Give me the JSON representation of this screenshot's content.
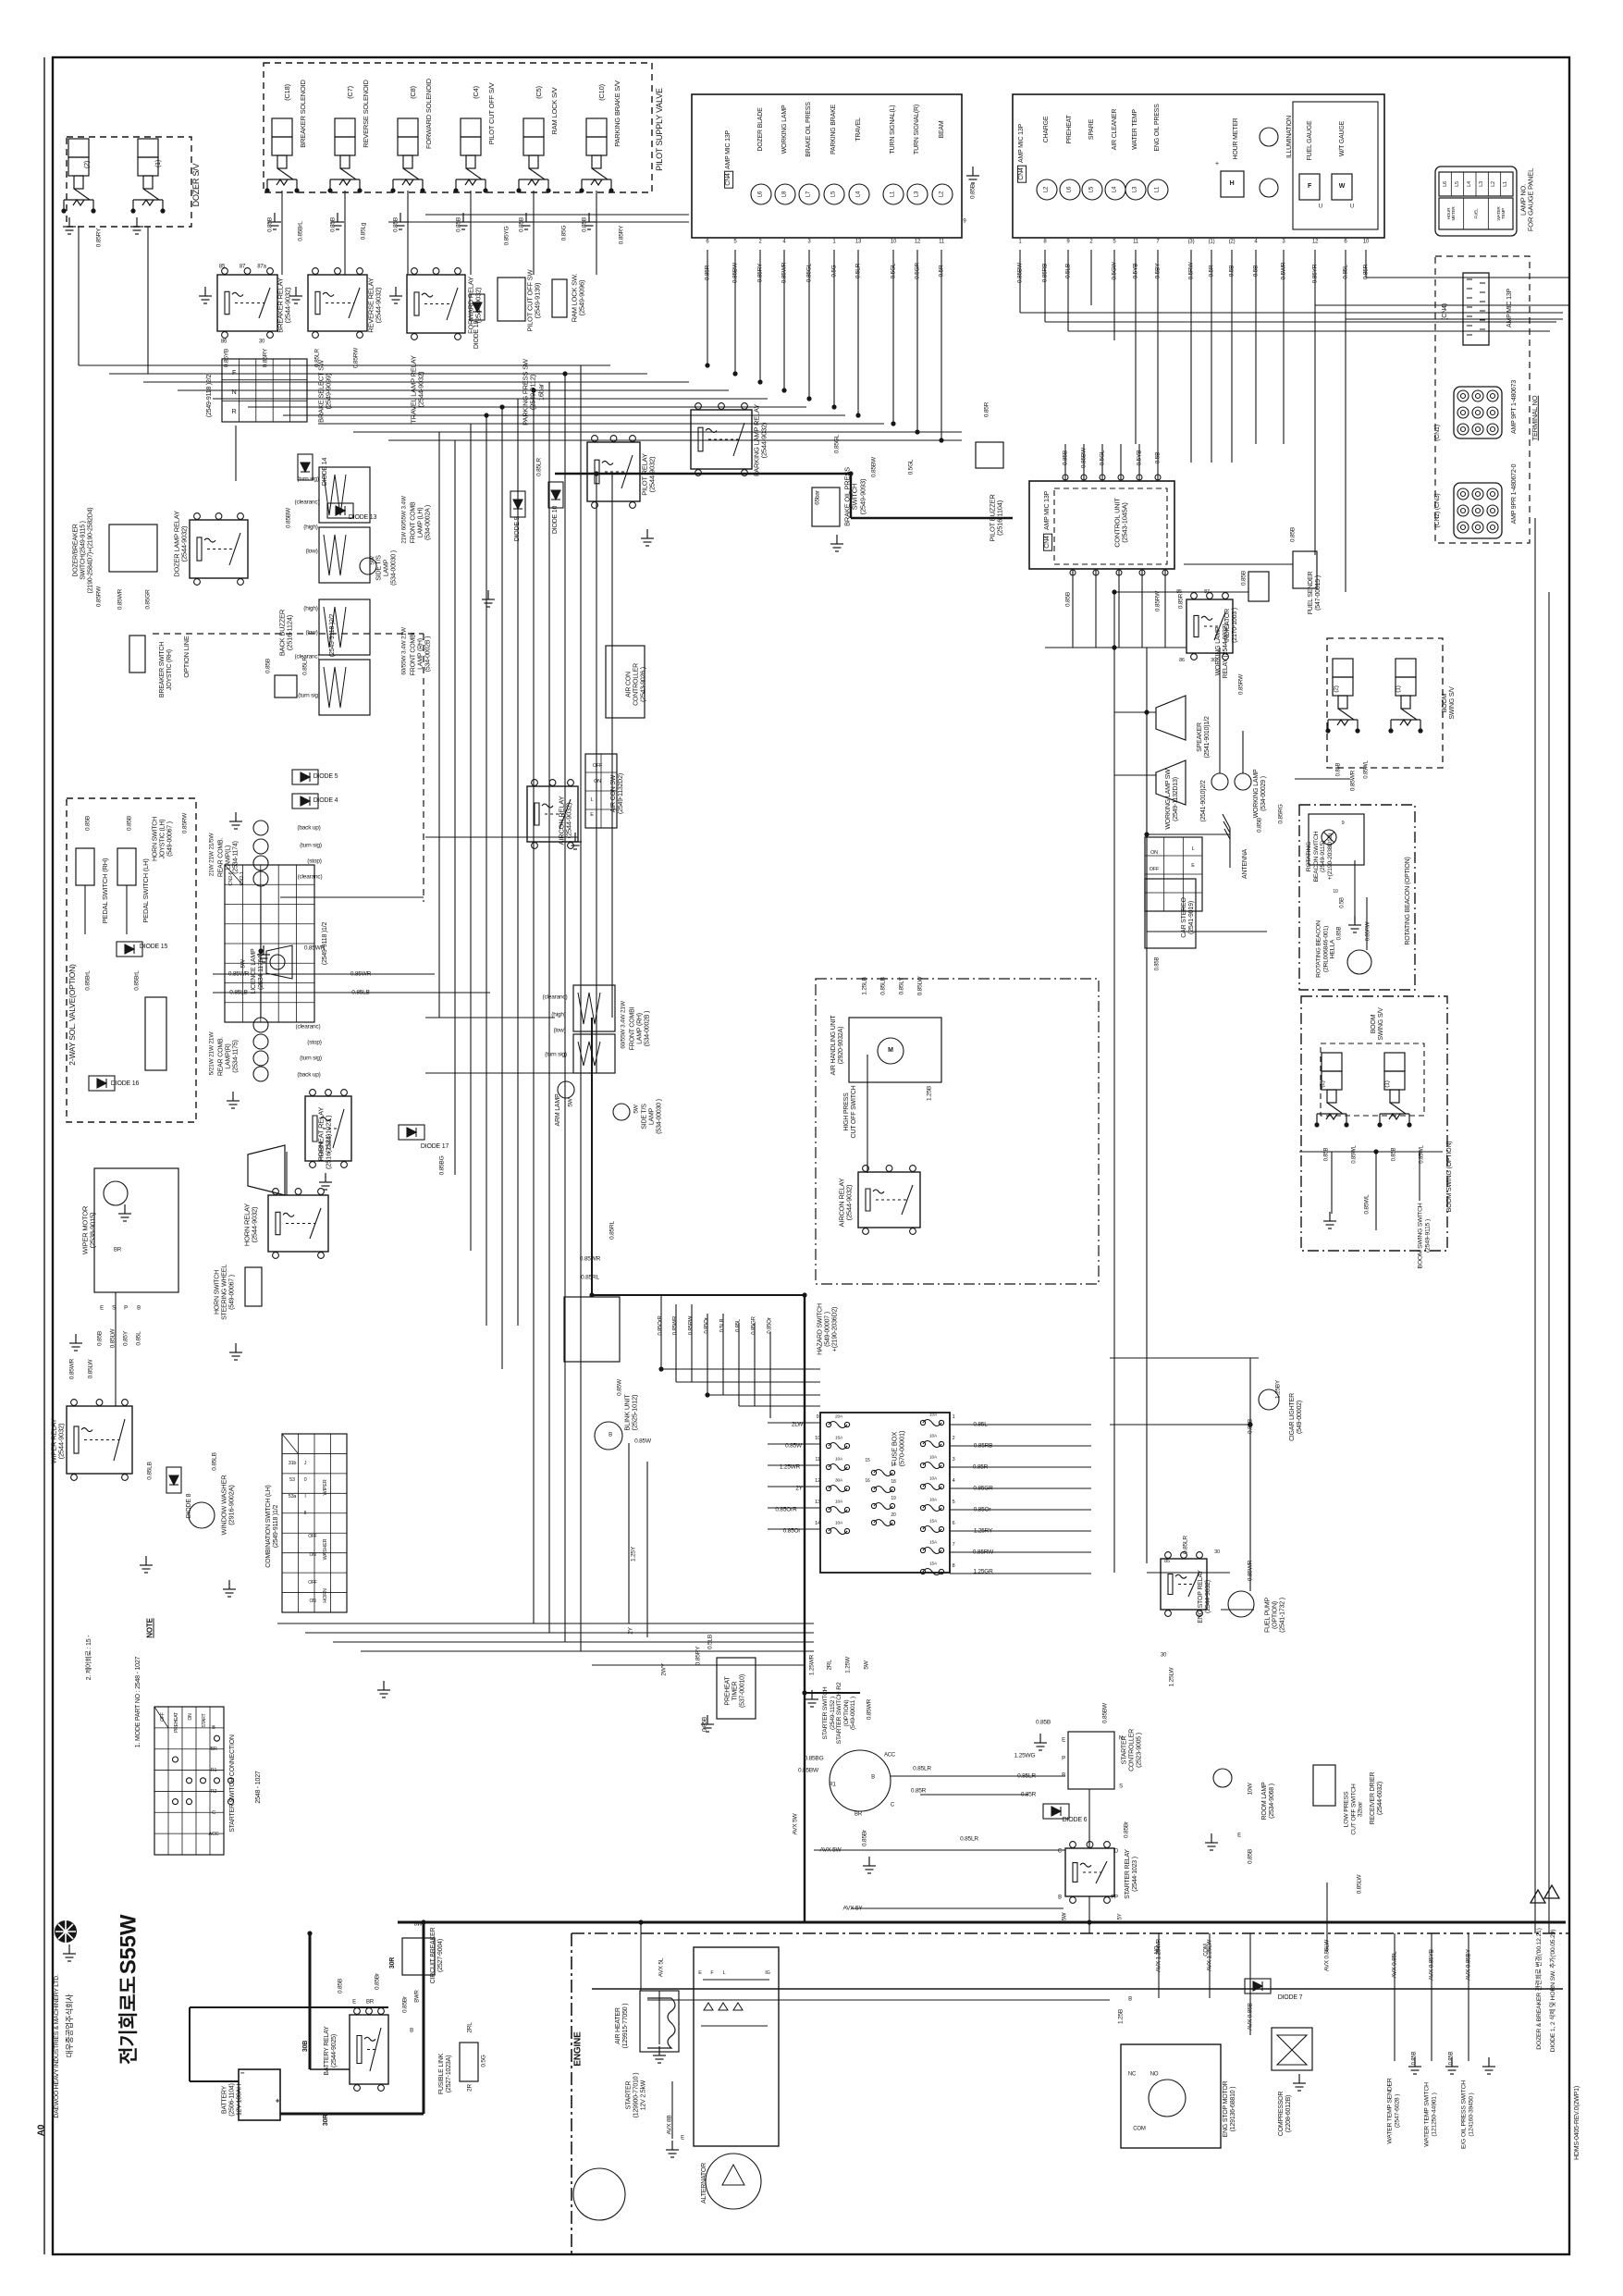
{
  "sheet": {
    "size": "A0",
    "model": "S55W",
    "title_kr": "전기회로도",
    "company_kr": "대우중공업주식회사",
    "company_en": "DAEWOO HEAVY INDUSTRIES & MACHINERY LTD.",
    "drawing_no": "HDMS-0405-REV.0(2WP1)"
  },
  "revisions": [
    "DIODE 1, 2 삭제 및 HORN SW. 추가('00.05.29)",
    "DOZER & BREAKER 관련회로 변경('00.12.21)"
  ],
  "notes": {
    "title": "NOTE",
    "n1": "1. MODE PART NO : 2548 - 1027",
    "n2": "2. 제어회로 : 15 -"
  },
  "console": {
    "name": "CONSOLE ASS'Y\n(539-0000B )",
    "lamps": [
      {
        "id": "L6",
        "label": "DOZER BLADE"
      },
      {
        "id": "L8",
        "label": "WORKING LAMP"
      },
      {
        "id": "L7",
        "label": "BRAKE OIL PRESS"
      },
      {
        "id": "L5",
        "label": "PARKING BRAKE"
      },
      {
        "id": "L4",
        "label": "TRAVEL"
      },
      {
        "id": "L1",
        "label": "TURN SIGNAL(L)"
      },
      {
        "id": "L3",
        "label": "TURN SIGNAL(R)"
      },
      {
        "id": "L2",
        "label": "BEAM"
      }
    ],
    "pins": [
      "6",
      "5",
      "2",
      "4",
      "3",
      "1",
      "13",
      "10",
      "12",
      "11"
    ],
    "wires": [
      "0.85R",
      "0.85BW",
      "0.85RY",
      "0.85WR",
      "0.85GL",
      "0.5G",
      "0.5LR",
      "0.5GL",
      "0.5GR",
      "0.5R"
    ]
  },
  "gauge": {
    "name": "GAUGE PANEL\n(2539-1075)",
    "lamps": [
      {
        "id": "L2",
        "label": "CHARGE"
      },
      {
        "id": "L6",
        "label": "PREHEAT"
      },
      {
        "id": "L5",
        "label": "SPARE"
      },
      {
        "id": "L4",
        "label": "AIR CLEANER"
      },
      {
        "id": "L3",
        "label": "WATER TEMP"
      },
      {
        "id": "L1",
        "label": "ENG OIL PRESS"
      }
    ],
    "hour_meter": "HOUR METER",
    "illumination": "ILLUMINATION",
    "fuel_gauge": "FUEL GAUGE",
    "wt_gauge": "W/T GAUGE",
    "pins": [
      "1",
      "8",
      "9",
      "2",
      "5",
      "11",
      "7",
      "(3)",
      "(1)",
      "(2)",
      "4",
      "3",
      "12",
      "6",
      "10"
    ],
    "wires": [
      "0.85BW",
      "0.85RB",
      "0.5LB",
      "0.5GW",
      "0.5YB",
      "0.5BY",
      "0.5RW",
      "0.5R",
      "0.5B",
      "0.5B",
      "0.5WR",
      "0.85YR",
      "0.85L",
      "0.85R"
    ]
  },
  "lamp_no": {
    "title": "LAMP NO.\nFOR GAUGE PANEL",
    "row1": [
      "L6",
      "L5",
      "L4",
      "L3",
      "L2",
      "L1"
    ],
    "row2": [
      "HOUR\nMETER",
      "FUEL",
      "WATER\nTEMP"
    ]
  },
  "terminal": {
    "title": "TERMINAL NO",
    "items": [
      {
        "name": "AMP MIC 13P",
        "cn": "(CN4)"
      },
      {
        "name": "AMP 9PT 1-480673",
        "cn": "(CN1)"
      },
      {
        "name": "AMP 9PR 1-480672-0",
        "cn": "(CN2) (CN3)"
      }
    ]
  },
  "fuse_box": {
    "name": "FUSE BOX\n(570-00001)",
    "left_wires": [
      "2LW",
      "0.85W",
      "1.25WR",
      "2Y",
      "0.85OrR",
      "0.85Or"
    ],
    "left_pins": [
      "9",
      "10",
      "11",
      "12",
      "13",
      "14"
    ],
    "right_pins": [
      "1",
      "2",
      "3",
      "4",
      "5",
      "6",
      "7",
      "8"
    ],
    "right_wires": [
      "0.85L",
      "0.85RB",
      "0.85R",
      "0.85GR",
      "0.85Or",
      "1.25RY",
      "0.85RW",
      "1.25GR"
    ],
    "mid_pins": [
      "17",
      "18",
      "19",
      "20"
    ],
    "side_pins": [
      "15",
      "16"
    ],
    "ratings_left": [
      "20A",
      "15A",
      "10A",
      "30A",
      "10A",
      "10A"
    ],
    "ratings_right": [
      "10A",
      "10A",
      "10A",
      "10A",
      "10A",
      "15A",
      "15A",
      "15A"
    ],
    "bottom_wires": [
      "1.25WR",
      "2RL",
      "1.25W",
      "5W"
    ]
  },
  "starter_conn": {
    "title": "STARTER SWITCH CONNECTION",
    "part": "2548 - 1027",
    "terminals": [
      "B",
      "BR",
      "R1",
      "R2",
      "C",
      "ACC"
    ],
    "positions": [
      "OFF",
      "PREHEAT",
      "ON",
      "START"
    ]
  },
  "c": {
    "pilot_supply_valve": "PILOT SUPPLY VALVE",
    "dozer_sv": "DOZER S/V",
    "breaker_solenoid": "BREAKER SOLENOID",
    "reverse_solenoid": "REVERSE SOLENOID",
    "forward_solenoid": "FORWARD SOLENOID",
    "pilot_cutoff_sv": "PILOT CUT OFF S/V",
    "ram_lock_sv": "RAM LOCK S/V",
    "parking_brake_sv": "PARKING BRAKE S/V",
    "breaker_relay": "BREAKER RELAY\n(2544-9032)",
    "reverse_relay": "REVERSE RELAY\n(2544-9032)",
    "forward_relay": "FORWARD RELAY\n(2544-9032)",
    "pilot_cutoff_sw": "PILOT CUT OFF SW\n(2549-9139)",
    "ram_lock_sw": "RAM LOCK SW.\n(2549-9096)",
    "parking_lamp_relay": "PARKING LAMP RELAY\n(2544-9032)",
    "pilot_relay": "PILOT RELAY\n(2544-9032)",
    "travel_lamp_relay": "TRAVEL LAMP RELAY\n(2544-9032)",
    "brake_select_sw": "BRAKE SELECT SW\n(2549-9099)",
    "parking_press_sw": "PARKING PRESS SW\n(2549-9112)\n16bar",
    "fnr_select": "(2549-9118 )2/2",
    "comb12": "(2549-9118 )1/2",
    "diode4": "DIODE 4",
    "diode5": "DIODE 5",
    "diode6": "DIODE 6",
    "diode7": "DIODE 7",
    "diode8": "DIODE 8",
    "diode9": "DIODE 9",
    "diode10": "DIODE 10",
    "diode13": "DIODE 13",
    "diode14": "DIODE 14",
    "diode15": "DIODE 15",
    "diode16": "DIODE 16",
    "diode17": "DIODE 17",
    "diode18": "DIODE 18",
    "brake_oil_press_switch": "BRAKE OIL PRESS\nSWITCH\n(2549-9093)",
    "pilot_buzzer": "PILOT BUZZER\n(2516-1104)",
    "control_unit": "CONTROL UNIT\n(2543-1045A)",
    "amp_mic": "AMP MIC 13P",
    "dozer_breaker_switch": "DOZER/BREAKER\nSWITCH(2549-9115 )\n(2190-2584D7)+(2190-2582D4)",
    "dozer_lamp_relay": "DOZER LAMP RELAY\n(2544-9032)",
    "back_buzzer": "BACK BUZZER\n(2516-1124)",
    "option_line": "OPTION LINE",
    "breaker_sw_joystic": "BREAKER SWITCH\nJOYSTIC (RH)",
    "horn_sw_joystic": "HORN SWITCH\nJOYSTIC (LH)\n(549-00067 )",
    "pedal_sw_rh": "PEDAL SWITCH (RH)",
    "pedal_sw_lh": "PEDAL SWITCH (LH)",
    "two_way_sol": "2-WAY SOL. VALVE(OPTION)",
    "rear_comb_l": "REAR COMB.\nLAMP(L)\n(2534-1174)",
    "rear_comb_r": "REAR COMB.\nLAMP(R)\n(2534-1175)",
    "licence_lamp": "LICENCE LAMP\n(2534-1176A)",
    "horn": "HORN\n(2516-1121)",
    "horn_relay": "HORN RELAY\n(2544-9032)",
    "horn_sw_steering": "HORN SWITCH\nSTEERING WHEEL\n(549-00067 )",
    "wiper_motor": "WIPER MOTOR\n(2538-9015)",
    "wiper_relay": "WIPER RELAY\n(2544-9032)",
    "window_washer": "WINDOW WASHER\n(2916-9002A)",
    "combination_sw": "COMBINATION SWITCH (LH)\n(2549-9118 )1/2",
    "front_comb_lh": "FRONT COMB\nLAMP (LH)\n(534-0002A )",
    "front_comb_rh": "FRONT COMBI\nLAMP (RH)\n(534-0002B )",
    "side_ts1": "SIDE T/S\nLAMP\n(534-00030 )",
    "arm_lamp": "ARM LAMP",
    "hazard_switch": "HAZARD SWITCH\n(549-00007 )\n+(2190-2036D2)",
    "aircon_controller": "AIR CON\nCONTROLLER\n(2543-9026 )",
    "aircon_sw": "AIR CON SW\n(2549-1132D2)",
    "aircon_relay": "AIRCON RELAY\n(2544-9032)",
    "air_handling": "AIR HANDLING UNIT\n(2920-9032A)",
    "blink_unit": "BLINK UNIT\n(2525-1012)",
    "preheat_timer": "PREHEAT\nTIMER\n(537-00010)",
    "preheat_relay": "PREHEAT RELAY\n(2544-1023 )",
    "starter_switch": "STARTER SWITCH\n(2549-1152 )\nSTARTER SWITCH R2\n(OPTION)\n(549-00011 )",
    "starter_controller": "STARTER\nCONTROLLER\n(2523-9005 )",
    "starter_relay": "STARTER RELAY\n(2544-1023 )",
    "starter": "STARTER\n(129900-77010 )\n12V 2.5kW",
    "room_lamp": "ROOM LAMP\n(2534-9068 )",
    "receiver_drier": "RECEIVER DRIER\n(2544-6032)",
    "low_press": "LOW PRESS\nCUT OFF SWITCH\n32bar",
    "high_press": "HIGH PRESS\nCUT OFF SWITCH",
    "eng_stop_motor": "ENG STOP MOTOR\n(129136-68810 )",
    "compressor": "COMPRESSOR\n(2208-6012B)",
    "air_heater": "AIR HEATER\n(129915-77050 )",
    "engine": "ENGINE",
    "circuit_breaker": "CIRCUIT BREAKER\n(2527-9004)",
    "fusible_link": "FUSIBLE LINK\n(2527-1023A)",
    "battery_relay": "BATTERY RELAY\n(2544-9025)",
    "battery": "BATTERY\n(2506-1104)\n12V 100AH",
    "alternator": "ALTERNATOR",
    "fuel_sender": "FUEL SENDER\n(547-00015 )",
    "indicator": "INDICATOR\n(2170-1003 )",
    "working_lamp": "WORKING LAMP\n(534-00029 )",
    "working_lamp_sw": "WORKING LAMP SW\n(2549-1132D13)",
    "working_lamp_relay": "WORKING LAMP\nRELAY (2544-9032)",
    "rotating_beacon_opt": "ROTATING BEACON (OPTION)",
    "rotating_beacon_sw": "ROTATING\nBEACON SWITCH\n(2549-9115)\n+(2190-2038D10)",
    "rotating_beacon": "ROTATING BEACON\n(2RL006846-001)\nHELLA",
    "boom_swing_opt": "BOOM SWING (OPTION)",
    "boom_swing_sv": "BOOM\nSWING S/V",
    "boom_swing_sw": "BOOM SWING SWITCH\n(2549-9115 )",
    "speaker": "SPEAKER\n(2541-9010)1/2",
    "speaker2": "(2541-9010)2/2",
    "antenna": "ANTENNA",
    "car_stereo": "CAR STEREO\n(2541-9019)",
    "cigar_lighter": "CIGAR LIGHTER\n(549-00002)",
    "fuel_pump": "FUEL PUMP\n(OPTION)\n(2541-1732 )",
    "eng_stop_relay": "ENG STOP RELAY\n(2544-9032)",
    "water_temp_sender": "WATER TEMP SENDER\n(2547-6028 )",
    "water_temp_switch": "WATER TEMP SWITCH\n(121250-44901 )",
    "eg_oil_press_switch": "E/G OIL PRESS SWITCH\n(124160-39450 )"
  },
  "w": {
    "p1": "(1)",
    "p2": "(2)",
    "c18": "(C18)",
    "c7": "(C7)",
    "c8": "(C8)",
    "c4": "(C4)",
    "c5": "(C5)",
    "c10": "(C10)",
    "b085": "0.85B",
    "brl085": "0.85BrL",
    "lg085": "0.85Lg",
    "yg085": "0.85YG",
    "g085": "0.85G",
    "ry085": "0.85RY",
    "yb085": "0.85YB",
    "lr085": "0.85LR",
    "rw085": "0.85RW",
    "wr085": "0.85WR",
    "gr085": "0.85GR",
    "r085": "0.85R",
    "bw085": "0.85BW",
    "gl085": "0.85GL",
    "rb085": "0.85RB",
    "yr085": "0.85YR",
    "l085": "0.85L",
    "w085": "0.85W",
    "lb085": "0.85LB",
    "lw085": "0.85LW",
    "or085": "0.85Or",
    "OrR085": "0.85OrR",
    "rl085": "0.85RL",
    "br085": "0.85Br",
    "bg085": "0.85BG",
    "rg085": "0.85RG",
    "wl085": "0.85WL",
    "y085": "0.85Y",
    "ly085": "0.85LY",
    "g05": "0.5G",
    "gl05": "0.5GL",
    "b05": "0.5B",
    "lb05": "0.5LB",
    "yb05": "0.5YB",
    "lw125": "1.25LW",
    "wr125": "1.25WR",
    "y125": "1.25Y",
    "b125": "1.25B",
    "by125": "1.25BY",
    "wg125": "1.25WG",
    "lb125": "1.25LB",
    "y2": "2Y",
    "rl2": "2RL",
    "r2": "2R",
    "wy2": "2WY",
    "w5": "5W",
    "y5": "5Y",
    "w8": "8W",
    "w10": "10W",
    "BWR": "BWR",
    "BR": "BR",
    "r30": "30R",
    "b30": "30B",
    "avx5l": "AVX 5L",
    "avx8b": "AVX 8B",
    "avx5w": "AVX 5W",
    "avx5y": "AVX 5Y",
    "avxwr125": "AVX 1.25WR",
    "avxlw125": "AVX 1.25LW",
    "avxlw085": "AVX 0.85LW",
    "avxb085": "AVX 0.85B",
    "avxl085": "AVX 0.85L",
    "avxyb085": "AVX 0.85YB",
    "avxby085": "AVX 0.85BY",
    "t85": "85",
    "t86": "86",
    "t87": "87",
    "t87a": "87a",
    "t30": "30",
    "t9": "9",
    "t10": "10",
    "t31b": "31b",
    "t53": "53",
    "t53a": "53a",
    "cn26": "CN2-6",
    "cn21": "CN2-1",
    "cn4": "CN4",
    "F": "F",
    "N": "N",
    "R": "R",
    "E": "E",
    "S": "S",
    "P": "P",
    "B": "B",
    "C": "C",
    "D": "D",
    "L": "L",
    "M": "M",
    "IG": "IG",
    "U": "U",
    "H": "H",
    "W": "W",
    "PP": "PP",
    "ACC": "ACC",
    "R1": "R1",
    "NC": "NC",
    "NO": "NO",
    "COM": "COM",
    "J": "J",
    "n0": "0",
    "I": "I",
    "II": "II",
    "ON": "ON",
    "OFF": "OFF",
    "WIPER": "WIPER",
    "WASHER": "WASHER",
    "HORN": "HORN",
    "plus": "+",
    "minus": "−",
    "backup": "(back up)",
    "turnsig": "(turn sig)",
    "stop": "(stop)",
    "clear": "(clearanc)",
    "high": "(high)",
    "low": "(low)",
    "bar65": "65bar",
    "rl_w": "21W 21W 21/5W",
    "rr_w": "5/21W 21W 21W",
    "flh_w": "21W 60/55W 3.4W",
    "frh_w": "60/55W 3.4W 21W",
    "f10a": "10A",
    "f15a": "15A",
    "f20a": "20A",
    "f30a": "30A"
  }
}
